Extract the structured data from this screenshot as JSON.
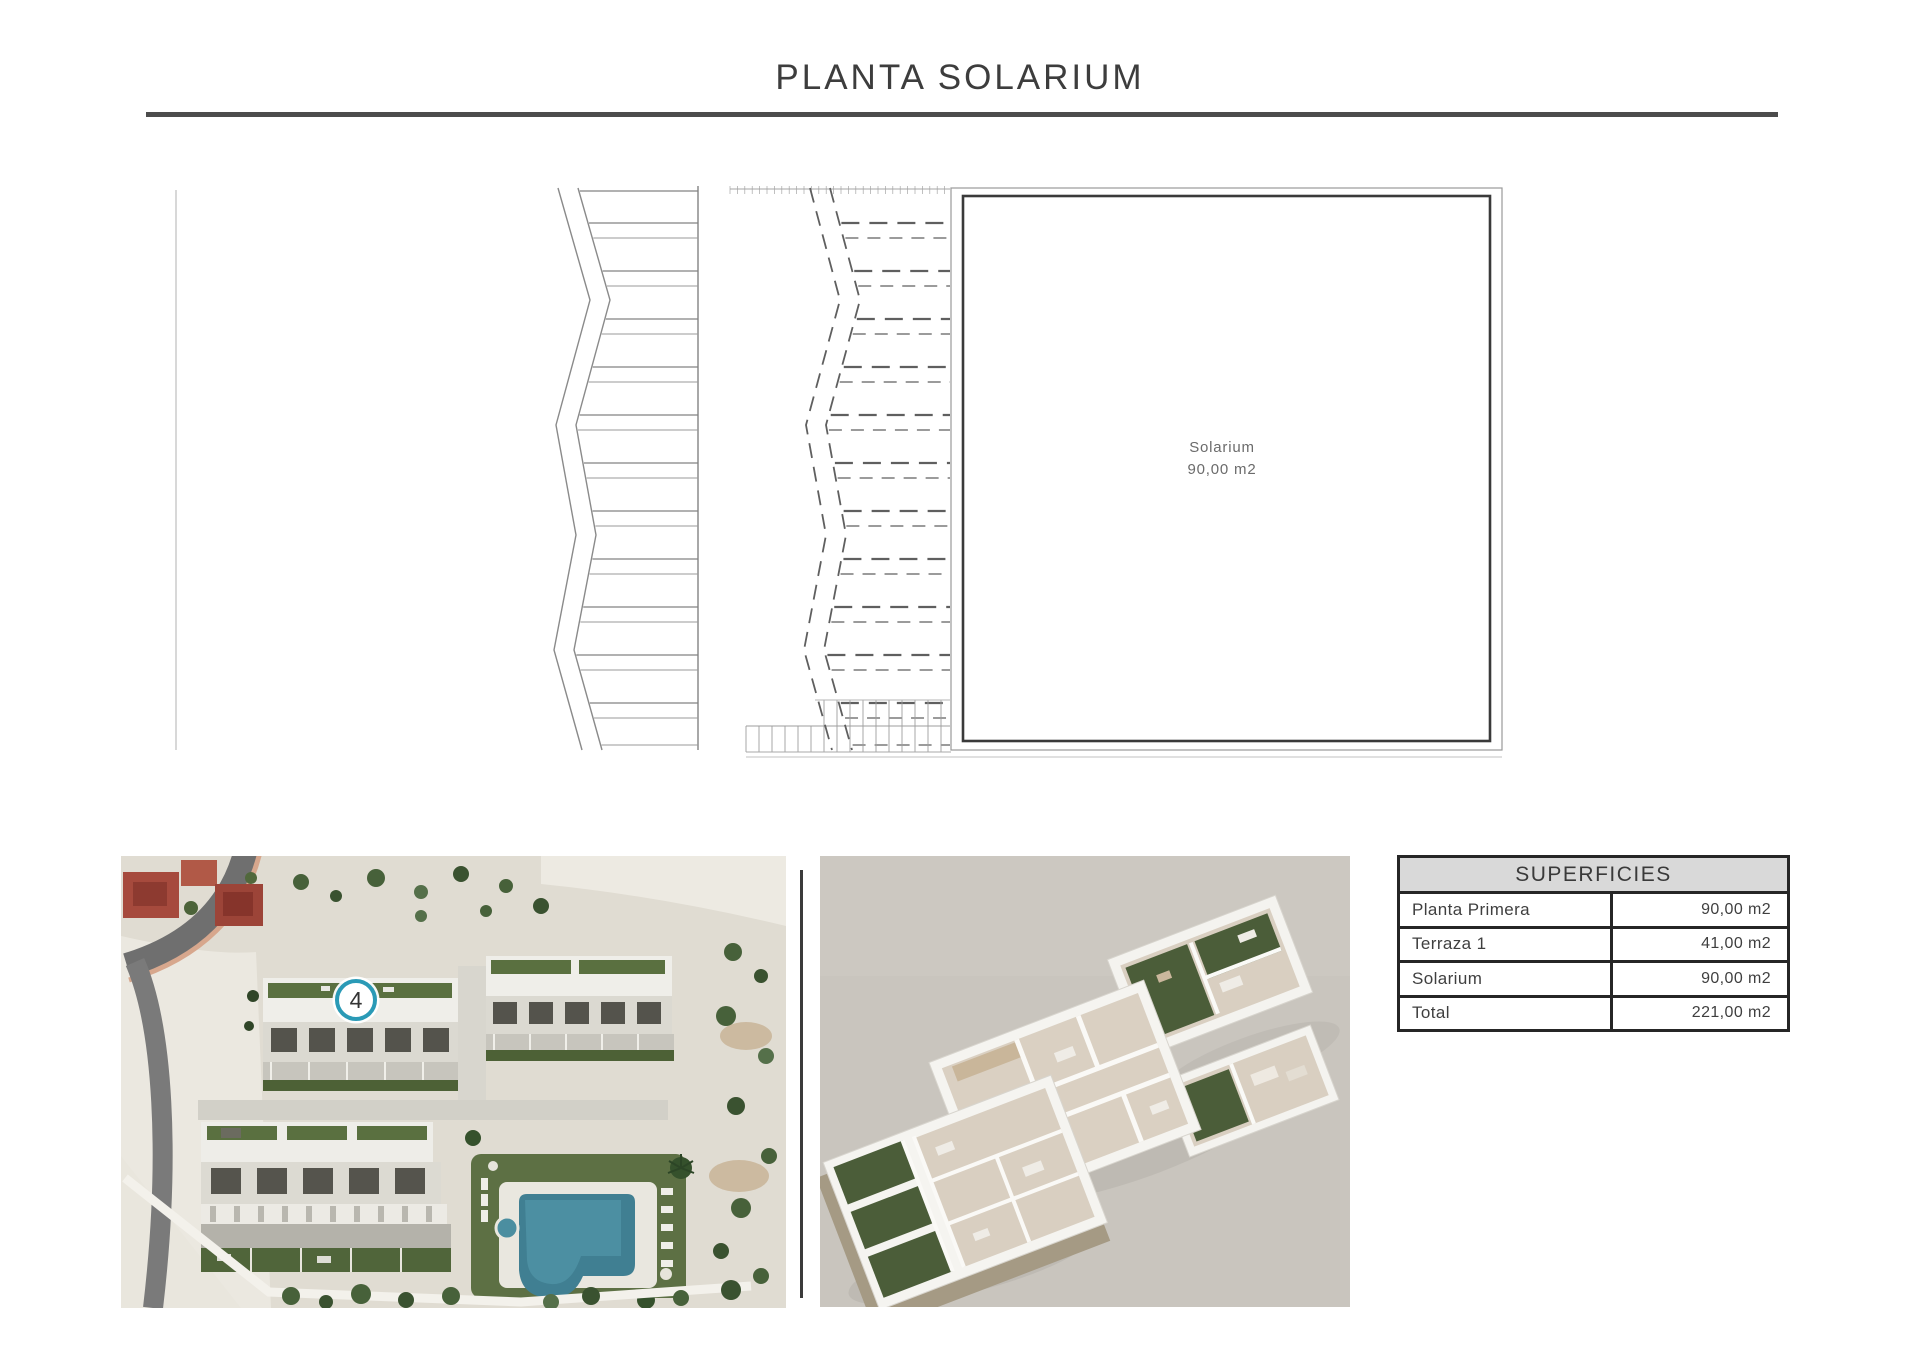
{
  "page": {
    "title": "PLANTA SOLARIUM"
  },
  "plan": {
    "room_label": "Solarium",
    "room_area": "90,00 m2"
  },
  "site_photo": {
    "unit_badge": "4"
  },
  "table": {
    "header": "SUPERFICIES",
    "rows": [
      {
        "label": "Planta Primera",
        "value": "90,00 m2"
      },
      {
        "label": "Terraza 1",
        "value": "41,00 m2"
      },
      {
        "label": "Solarium",
        "value": "90,00 m2"
      },
      {
        "label": "Total",
        "value": "221,00 m2"
      }
    ]
  },
  "colors": {
    "accent_teal": "#2a9ab6",
    "title_rule": "#4c4c4c",
    "table_border": "#262626",
    "table_header_bg": "#d9d9d9",
    "render_background": "#c9c5be",
    "pool_water": "#407f92"
  }
}
